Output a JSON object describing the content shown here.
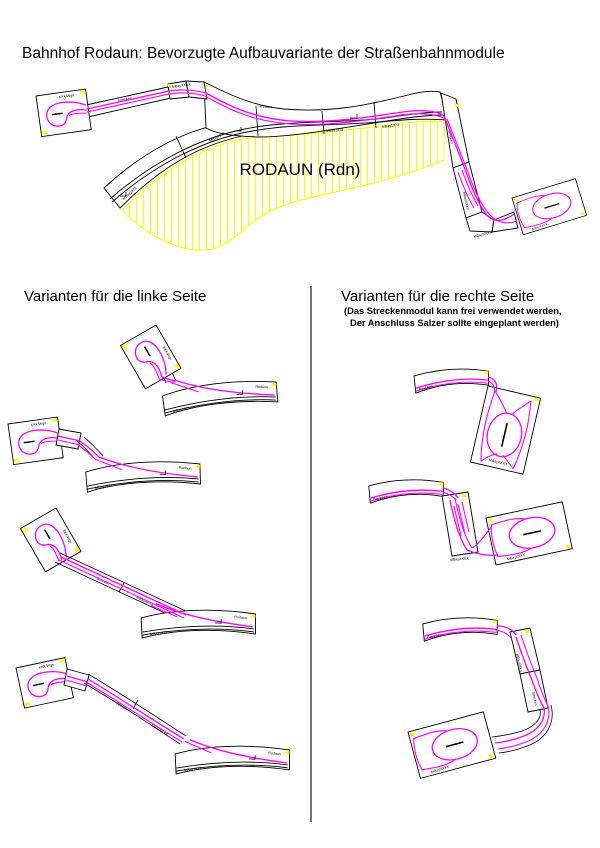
{
  "page": {
    "title": "Bahnhof Rodaun: Bevorzugte Aufbauvariante der Straßenbahnmodule"
  },
  "main_diagram": {
    "station_label": "RODAUN (Rdn)"
  },
  "sections": {
    "left": {
      "header": "Varianten für die linke Seite"
    },
    "right": {
      "header": "Varianten für die rechte Seite",
      "note_line1": "(Das Streckenmodul kann frei verwendet werden,",
      "note_line2": "Der Anschluss Salzer sollte eingeplant werden)"
    }
  },
  "module_labels": {
    "loop": "XXX/Wgn",
    "turnout_station": "Rodaun",
    "track_1973": "MBay1973",
    "track_xxxx": "MBayXXXX",
    "strecke": "Strecken",
    "bay1973": "Bay1973"
  },
  "colors": {
    "track_magenta": "#ff00ff",
    "hatch_yellow": "#ffff00",
    "outline_black": "#000000",
    "background": "#ffffff"
  }
}
